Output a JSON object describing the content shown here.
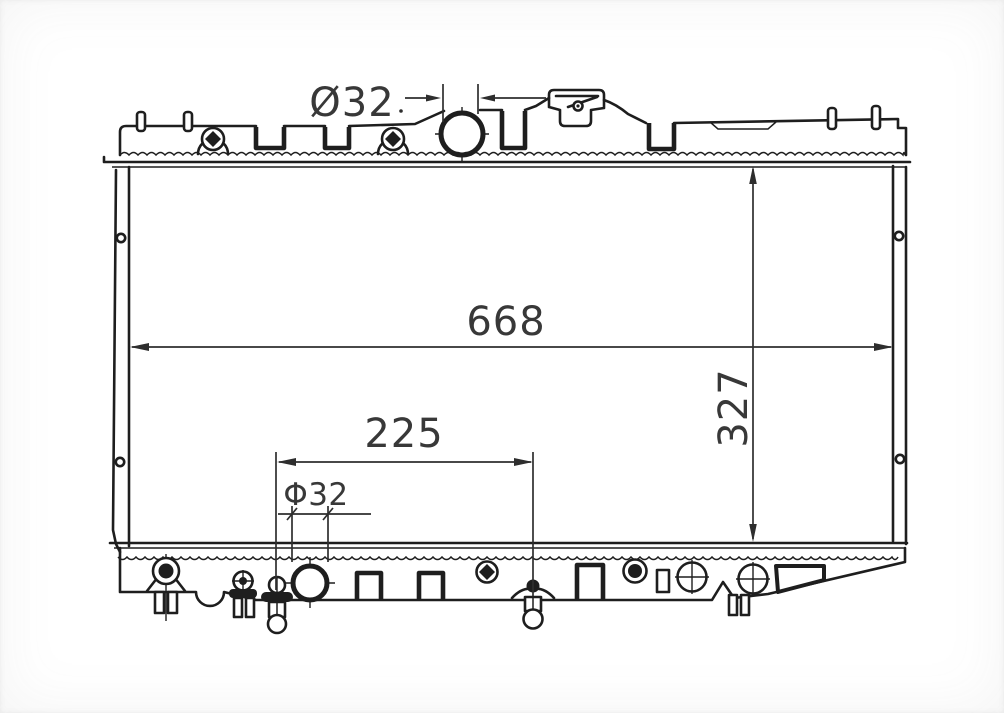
{
  "drawing": {
    "kind": "radiator-outline-drawing"
  },
  "dimensions": {
    "top_port_diameter": {
      "label": "Ø32"
    },
    "core_width": {
      "label": "668"
    },
    "core_height": {
      "label": "327"
    },
    "bottom_port_offset": {
      "label": "225"
    },
    "bottom_port_diameter": {
      "label": "Φ32"
    }
  },
  "colors": {
    "background": "#ffffff",
    "line": "#1e1e1e",
    "dim": "#2e2e2e"
  }
}
